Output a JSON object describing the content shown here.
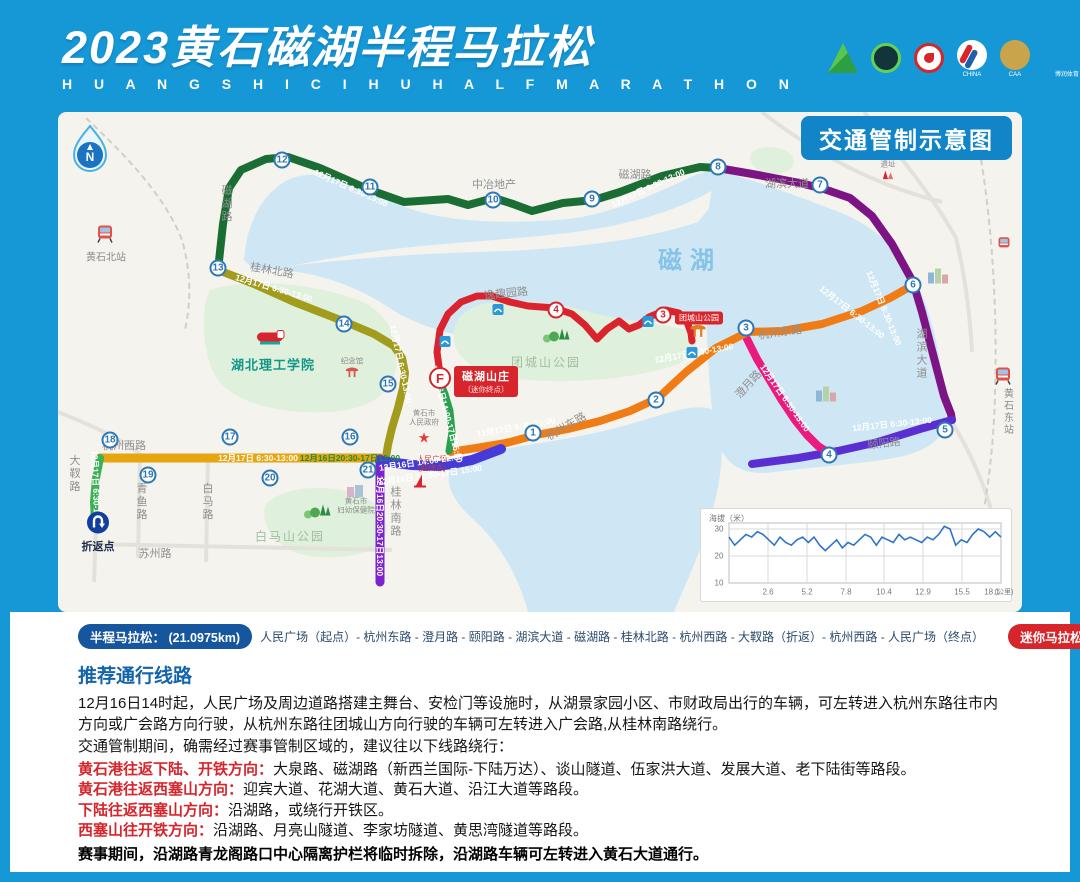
{
  "header": {
    "title": "2023黄石磁湖半程马拉松",
    "subtitle": "H U A N G S H I C I H U H A L F M A R A T H O N",
    "series": "武鄂黄黄系列赛",
    "logos": [
      {
        "cls": "l-mount",
        "text": ""
      },
      {
        "cls": "l-ring",
        "text": ""
      },
      {
        "cls": "l-red",
        "text": ""
      },
      {
        "cls": "l-run",
        "text": "CHINA"
      },
      {
        "cls": "l-caa",
        "text": "CAA"
      },
      {
        "cls": "l-brs",
        "text": "博润体育"
      },
      {
        "cls": "l-lot",
        "text": "中国体育彩票"
      }
    ],
    "brs_mark": "BRS",
    "caa_mark": "CAA",
    "lottery_mark": "✓"
  },
  "map": {
    "badge": "交通管制示意图",
    "compass_n": "N",
    "finish": {
      "marker": "F",
      "line1": "磁湖山庄",
      "line2": "〔迷你终点〕"
    },
    "markers": [
      {
        "n": "1",
        "x": 475,
        "y": 321
      },
      {
        "n": "2",
        "x": 598,
        "y": 288
      },
      {
        "n": "3",
        "x": 688,
        "y": 216
      },
      {
        "n": "4",
        "x": 771,
        "y": 343
      },
      {
        "n": "5",
        "x": 887,
        "y": 318
      },
      {
        "n": "6",
        "x": 855,
        "y": 173
      },
      {
        "n": "7",
        "x": 762,
        "y": 73
      },
      {
        "n": "8",
        "x": 660,
        "y": 55
      },
      {
        "n": "9",
        "x": 534,
        "y": 87
      },
      {
        "n": "10",
        "x": 435,
        "y": 88
      },
      {
        "n": "11",
        "x": 312,
        "y": 75
      },
      {
        "n": "12",
        "x": 224,
        "y": 48
      },
      {
        "n": "13",
        "x": 160,
        "y": 156
      },
      {
        "n": "14",
        "x": 286,
        "y": 212
      },
      {
        "n": "15",
        "x": 330,
        "y": 272
      },
      {
        "n": "16",
        "x": 292,
        "y": 325
      },
      {
        "n": "17",
        "x": 172,
        "y": 325
      },
      {
        "n": "18",
        "x": 52,
        "y": 328
      },
      {
        "n": "19",
        "x": 90,
        "y": 363
      },
      {
        "n": "20",
        "x": 212,
        "y": 366
      },
      {
        "n": "21",
        "x": 310,
        "y": 358
      },
      {
        "n": "4",
        "x": 498,
        "y": 198,
        "cls": "red"
      },
      {
        "n": "3",
        "x": 605,
        "y": 203,
        "cls": "red"
      }
    ],
    "time_labels": [
      {
        "text": "12月17日 6:30-13:00",
        "x": 293,
        "y": 76,
        "rot": 24
      },
      {
        "text": "12月17日 6:30-13:00",
        "x": 590,
        "y": 76,
        "rot": -25
      },
      {
        "text": "12月17日 6:30-13:00",
        "x": 826,
        "y": 196,
        "rot": 68
      },
      {
        "text": "12月17日 6:30-13:00",
        "x": 834,
        "y": 312,
        "rot": -6
      },
      {
        "text": "12月17日 6:30-13:00",
        "x": 727,
        "y": 286,
        "rot": 55
      },
      {
        "text": "12月17日 6:30-13:00",
        "x": 636,
        "y": 241,
        "rot": -10
      },
      {
        "text": "12月17日 6:30-13:00",
        "x": 458,
        "y": 315,
        "rot": -10
      },
      {
        "text": "12月17日 6:30-13:00",
        "x": 216,
        "y": 176,
        "rot": 16
      },
      {
        "text": "12月17日 6:30-13:00",
        "x": 343,
        "y": 252,
        "rot": 78
      },
      {
        "text": "12月17日 6:30-13:00",
        "x": 200,
        "y": 346,
        "rot": 0
      },
      {
        "text": "12月16日20:30-17日13:00",
        "x": 292,
        "y": 346,
        "rot": 0,
        "cls": "tgreen"
      },
      {
        "text": "12月16日 14:00-22:00",
        "x": 363,
        "y": 350,
        "rot": -8
      },
      {
        "text": "12月16日 22:00-17日 15:00",
        "x": 372,
        "y": 363,
        "rot": -8
      },
      {
        "text": "12月16日20:30-17日13:00",
        "x": 322,
        "y": 414,
        "rot": 90
      },
      {
        "text": "12月16日14:00-17日15:00",
        "x": 389,
        "y": 302,
        "rot": 75
      },
      {
        "text": "12月17日 6:30-13:00",
        "x": 38,
        "y": 378,
        "rot": 88
      },
      {
        "text": "12月17日 6:30-13:00",
        "x": 794,
        "y": 200,
        "rot": 38
      }
    ],
    "labels": [
      {
        "text": "磁湖",
        "x": 632,
        "y": 146,
        "cls": "lake"
      },
      {
        "text": "磁湖路",
        "x": 168,
        "y": 92,
        "cls": "v"
      },
      {
        "text": "磁湖路",
        "x": 577,
        "y": 62
      },
      {
        "text": "中冶地产",
        "x": 436,
        "y": 72
      },
      {
        "text": "湖滨大道",
        "x": 729,
        "y": 71
      },
      {
        "text": "湖滨大道",
        "x": 863,
        "y": 242,
        "cls": "v"
      },
      {
        "text": "杭州东路",
        "x": 722,
        "y": 220,
        "rot": -8
      },
      {
        "text": "杭州东路",
        "x": 508,
        "y": 314,
        "rot": -30
      },
      {
        "text": "澄月路",
        "x": 690,
        "y": 272,
        "rot": -48
      },
      {
        "text": "颐阳路",
        "x": 826,
        "y": 331,
        "rot": -6
      },
      {
        "text": "桂林北路",
        "x": 214,
        "y": 158,
        "rot": 10
      },
      {
        "text": "逸趣园路",
        "x": 448,
        "y": 181,
        "rot": -6
      },
      {
        "text": "杭州西路",
        "x": 66,
        "y": 333
      },
      {
        "text": "大靫路",
        "x": 16,
        "y": 362,
        "cls": "v"
      },
      {
        "text": "青鱼路",
        "x": 83,
        "y": 390,
        "cls": "v"
      },
      {
        "text": "白马路",
        "x": 149,
        "y": 390,
        "cls": "v"
      },
      {
        "text": "苏州路",
        "x": 97,
        "y": 441
      },
      {
        "text": "桂林南路",
        "x": 337,
        "y": 400,
        "cls": "v"
      },
      {
        "text": "团城山公园",
        "x": 488,
        "y": 250,
        "cls": "park"
      },
      {
        "text": "白马山公园",
        "x": 232,
        "y": 424,
        "cls": "park"
      },
      {
        "text": "湖北理工学院",
        "x": 215,
        "y": 252,
        "cls": "uni"
      },
      {
        "text": "黄石北站",
        "x": 48,
        "y": 144,
        "cls": "st"
      },
      {
        "text": "黄石东站",
        "x": 949,
        "y": 300,
        "cls": "st v"
      },
      {
        "text": "折返点",
        "x": 40,
        "y": 434,
        "cls": "turn"
      },
      {
        "text": "黄石市\n人民政府",
        "x": 366,
        "y": 306,
        "cls": "tiny pre"
      },
      {
        "text": "人民广场\n(起终点)",
        "x": 374,
        "y": 352,
        "cls": "tiny pre redtxt"
      },
      {
        "text": "黄石市\n妇幼保健院",
        "x": 298,
        "y": 394,
        "cls": "tiny pre"
      },
      {
        "text": "中窑水泥厂\n遗址",
        "x": 830,
        "y": 48,
        "cls": "tiny pre"
      },
      {
        "text": "纪念馆",
        "x": 294,
        "y": 250,
        "cls": "tiny"
      },
      {
        "text": "团城山公园",
        "x": 641,
        "y": 206,
        "cls": "redbadge"
      }
    ]
  },
  "chart_data": {
    "type": "line",
    "ylabel": "海拔（米）",
    "xunit": "(公里)",
    "ylim": [
      10,
      30
    ],
    "grid": true,
    "y_ticks": [
      {
        "t": "30",
        "x": 18,
        "y": 20
      },
      {
        "t": "20",
        "x": 18,
        "y": 47
      },
      {
        "t": "10",
        "x": 18,
        "y": 74
      }
    ],
    "x_ticks": [
      {
        "t": "2.6",
        "x": 67,
        "y": 83
      },
      {
        "t": "5.2",
        "x": 106,
        "y": 83
      },
      {
        "t": "7.8",
        "x": 145,
        "y": 83
      },
      {
        "t": "10.4",
        "x": 183,
        "y": 83
      },
      {
        "t": "12.9",
        "x": 222,
        "y": 83
      },
      {
        "t": "15.5",
        "x": 261,
        "y": 83
      },
      {
        "t": "18.1",
        "x": 291,
        "y": 83
      }
    ],
    "values": [
      27,
      24,
      26,
      28,
      27,
      29,
      28,
      26,
      24,
      27,
      25,
      24,
      26,
      27,
      25,
      27,
      24,
      22,
      24,
      26,
      23,
      25,
      24,
      26,
      28,
      27,
      24,
      27,
      26,
      25,
      28,
      26,
      27,
      26,
      25,
      27,
      26,
      28,
      31,
      30,
      24,
      26,
      25,
      28,
      30,
      29,
      27,
      29,
      27
    ]
  },
  "legend": {
    "half": {
      "label": "半程马拉松：",
      "dist": "(21.0975km)",
      "route": "人民广场（起点）- 杭州东路 - 澄月路 - 颐阳路 - 湖滨大道 - 磁湖路 - 桂林北路 - 杭州西路 - 大靫路（折返）- 杭州西路 - 人民广场（终点）"
    },
    "mini": {
      "label": "迷你马拉松：",
      "dist": "(5km)",
      "route": "人民广场（起点）- 杭州东路 - 逸趣园路 - 磁湖山庄（终点）"
    }
  },
  "notice": {
    "title": "推荐通行线路",
    "p1": "12月16日14时起，人民广场及周边道路搭建主舞台、安检门等设施时，从湖景家园小区、市财政局出行的车辆，可左转进入杭州东路往市内方向或广会路方向行驶，从杭州东路往团城山方向行驶的车辆可左转进入广会路,从桂林南路绕行。",
    "p2": "交通管制期间，确需经过赛事管制区域的，建议往以下线路绕行：",
    "detours": [
      {
        "head": "黄石港往返下陆、开铁方向：",
        "body": "大泉路、磁湖路（新西兰国际-下陆万达）、谈山隧道、伍家洪大道、发展大道、老下陆街等路段。"
      },
      {
        "head": "黄石港往返西塞山方向：",
        "body": "迎宾大道、花湖大道、黄石大道、沿江大道等路段。"
      },
      {
        "head": "下陆往返西塞山方向：",
        "body": "沿湖路，或绕行开铁区。"
      },
      {
        "head": "西塞山往开铁方向：",
        "body": "沿湖路、月亮山隧道、李家坊隧道、黄思湾隧道等路段。"
      }
    ],
    "final": "赛事期间，沿湖路青龙阁路口中心隔离护栏将临时拆除，沿湖路车辆可左转进入黄石大道通行。"
  }
}
